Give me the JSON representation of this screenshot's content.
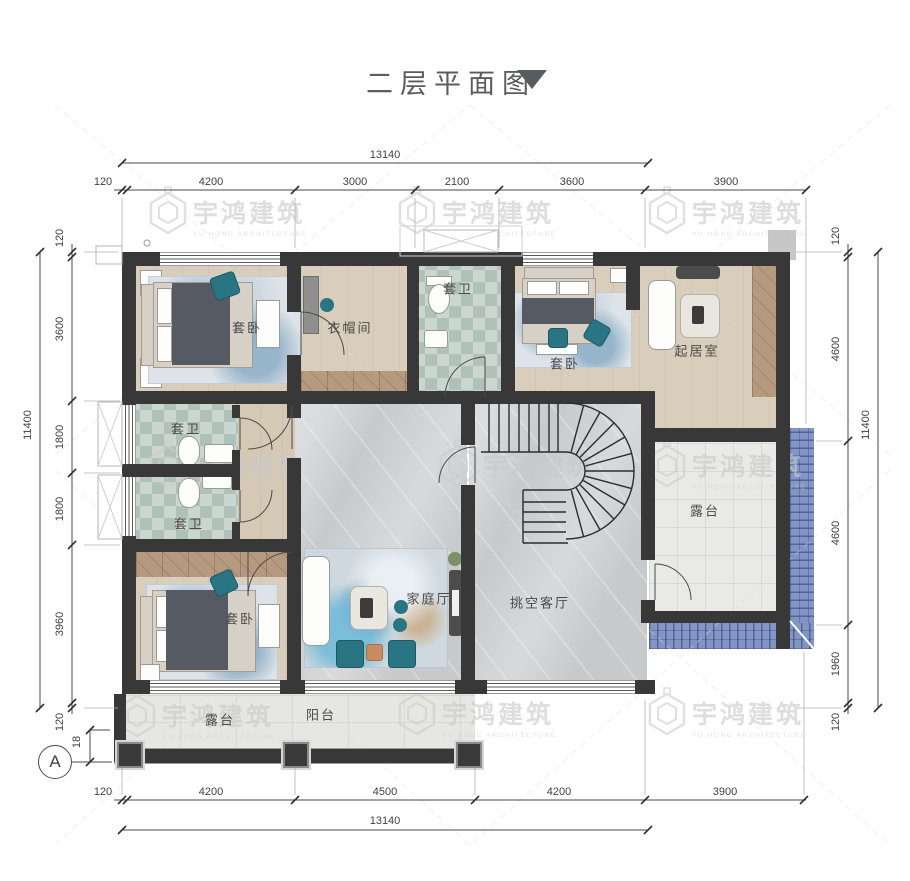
{
  "title": {
    "text": "二层平面图"
  },
  "watermark": {
    "cn": "宇鸿建筑",
    "en": "YU HONG ARCHITECTURE"
  },
  "grid": {
    "bubble": "A",
    "offset": "18"
  },
  "dims": {
    "top": {
      "total": "13140",
      "segments": [
        "120",
        "4200",
        "3000",
        "2100",
        "3600",
        "3900"
      ]
    },
    "bottom": {
      "total": "13140",
      "segments": [
        "120",
        "4200",
        "4500",
        "4200",
        "3900"
      ]
    },
    "left": {
      "total": "11400",
      "segments": [
        "120",
        "3600",
        "1800",
        "1800",
        "3960",
        "120"
      ]
    },
    "right": {
      "total": "11400",
      "segments": [
        "120",
        "4600",
        "4600",
        "1960",
        "120"
      ]
    }
  },
  "rooms": {
    "bedroom_tl": "套卧",
    "closet": "衣帽间",
    "bath_top": "套卫",
    "bedroom_tr": "套卧",
    "sitting": "起居室",
    "bath_mid_1": "套卫",
    "bath_mid_2": "套卫",
    "bedroom_bl": "套卧",
    "family_hall": "家庭厅",
    "void_living": "挑空客厅",
    "terrace_side": "露台",
    "terrace_front": "露台",
    "balcony": "阳台"
  },
  "colors": {
    "wall": "#383838",
    "wood_floor": "#d9cdbc",
    "marble_floor": "#c7c9cb",
    "bath_tile": "#b0c1b9",
    "roof_blue": "#8295c5",
    "accent_teal": "#2a7583",
    "watermark_gray": "#c9c9c9"
  }
}
